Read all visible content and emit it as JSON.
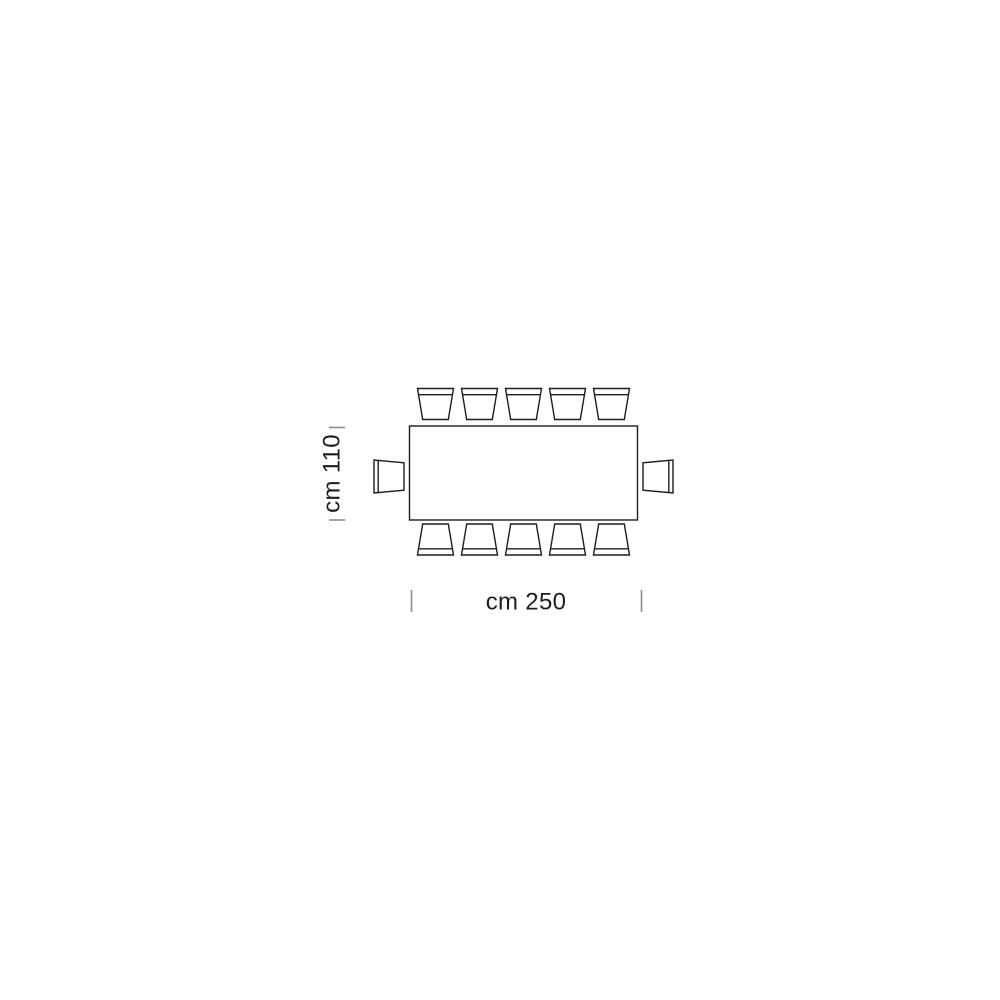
{
  "diagram": {
    "labels": {
      "depth": "cm 110",
      "width": "cm 250"
    },
    "seats": {
      "long_side_top": 5,
      "long_side_bottom": 5,
      "head_left": 1,
      "head_right": 1,
      "total": 12
    },
    "colors": {
      "outline": "#1d1d1b",
      "tick": "#8c8c8c",
      "text": "#1d1d1b",
      "table_fill": "#ffffff",
      "background": "#ffffff"
    }
  }
}
